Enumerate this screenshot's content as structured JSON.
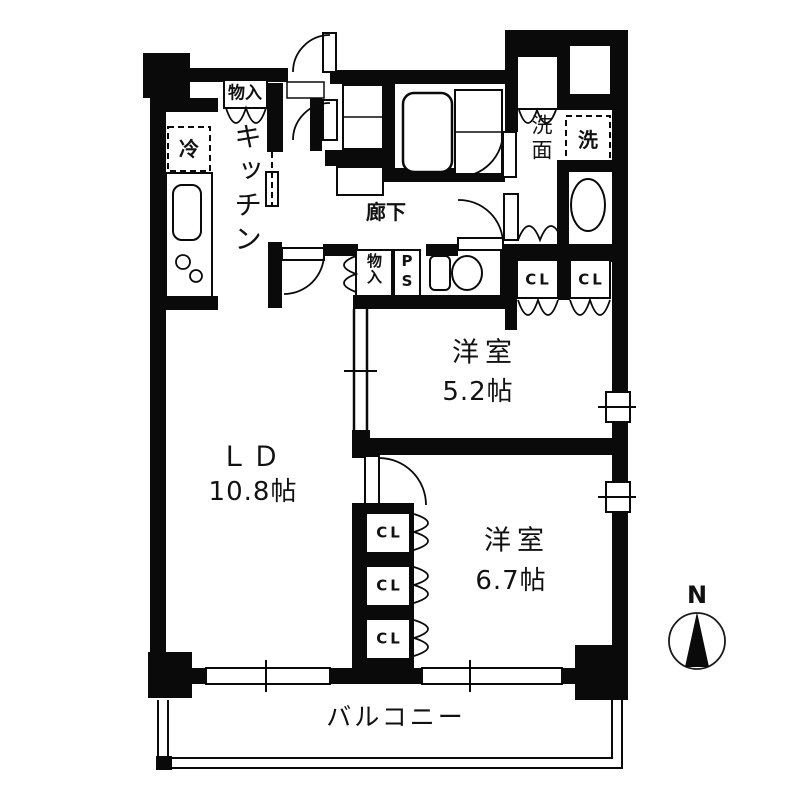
{
  "plan": {
    "type": "japanese-apartment-floor-plan",
    "labels": {
      "storage_top": "物入",
      "fridge": "冷",
      "kitchen": "キッチン",
      "corridor": "廊下",
      "storage_hall": "物入",
      "pipe_space": "PS",
      "washroom": "洗面",
      "washer": "洗",
      "closet": "CL",
      "balcony": "バルコニー",
      "compass_north": "N"
    },
    "rooms": [
      {
        "id": "western-room-1",
        "name": "洋室",
        "size": "5.2帖"
      },
      {
        "id": "living-dining",
        "name": "ＬＤ",
        "size": "10.8帖"
      },
      {
        "id": "western-room-2",
        "name": "洋室",
        "size": "6.7帖"
      }
    ],
    "closet_count_upper": 2,
    "closet_count_lower": 3,
    "colors": {
      "wall": "#0a0a0a",
      "bg": "#ffffff",
      "line": "#1a1a1a"
    }
  }
}
